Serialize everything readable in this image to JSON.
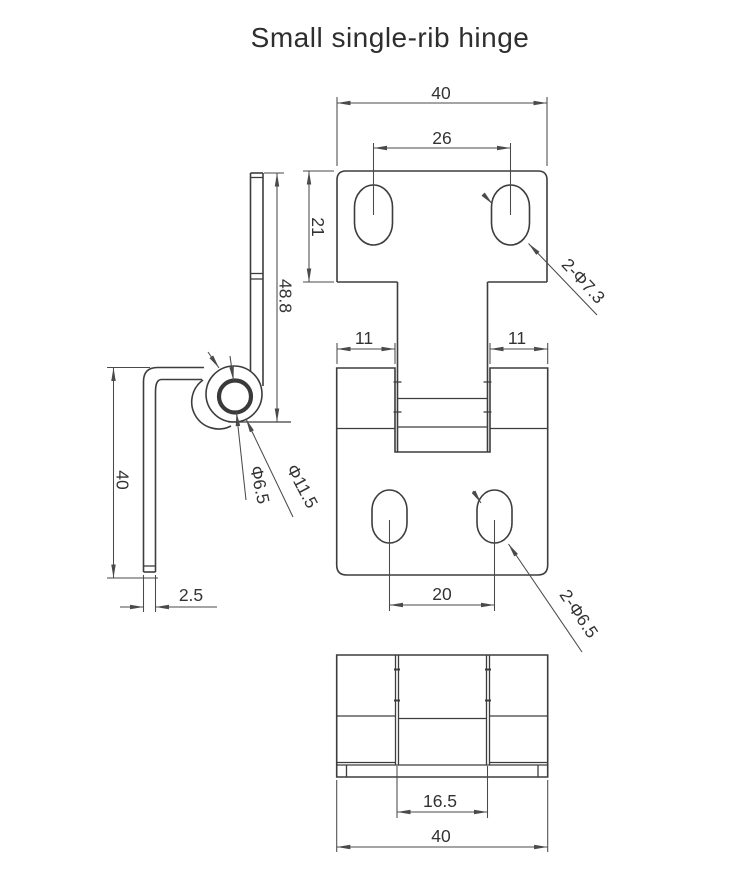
{
  "title": "Small single-rib hinge",
  "front_view": {
    "width_top": "40",
    "hole_pitch_top": "26",
    "plate_height": "21",
    "knuckle_left": "11",
    "knuckle_right": "11",
    "hole_pitch_bottom": "20",
    "top_holes_note": "2-Φ7.3",
    "bottom_holes_note": "2-Φ6.5"
  },
  "side_view": {
    "leaf_length": "48.8",
    "arm_length": "40",
    "thickness": "2.5",
    "pin_hole_dia": "Φ6.5",
    "barrel_dia": "Φ11.5"
  },
  "bottom_view": {
    "tongue_width": "16.5",
    "overall_width": "40"
  },
  "colors": {
    "line": "#3d3d3d",
    "dimension": "#4a4a4a",
    "text": "#333333",
    "background": "#ffffff"
  }
}
